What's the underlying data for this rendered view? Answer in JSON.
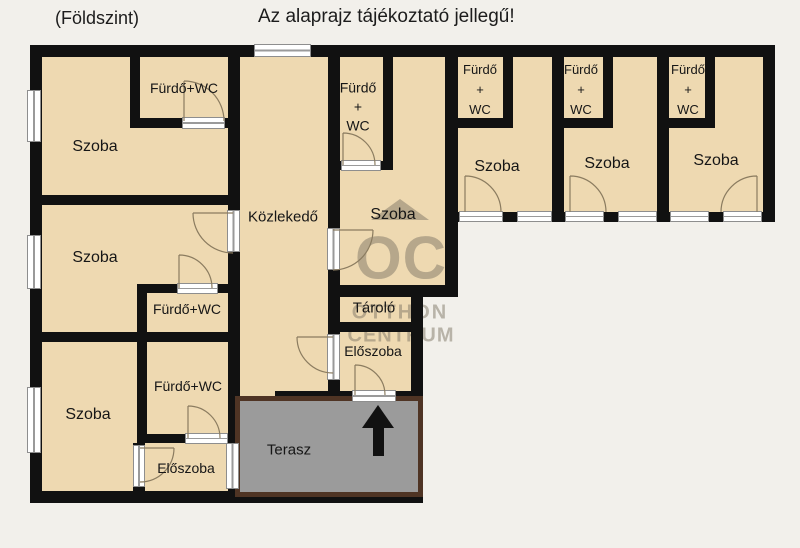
{
  "header": {
    "floor_label": "(Földszint)",
    "disclaimer": "Az alaprajz tájékoztató jellegű!"
  },
  "watermark": {
    "brand_initials": "OC",
    "brand_line1": "OTTHON",
    "brand_line2": "CENTRUM",
    "color": "#7d7566"
  },
  "rooms": {
    "szoba_top_left": {
      "label": "Szoba"
    },
    "furdo_top_left": {
      "label": "Fürdő+WC"
    },
    "szoba_mid_left": {
      "label": "Szoba"
    },
    "furdo_mid_left": {
      "label": "Fürdő+WC"
    },
    "szoba_bottom_left": {
      "label": "Szoba"
    },
    "furdo_bottom_left": {
      "label": "Fürdő+WC"
    },
    "eloszoba_left": {
      "label": "Előszoba"
    },
    "kozlekedo": {
      "label": "Közlekedő"
    },
    "furdo_middle": {
      "line1": "Fürdő",
      "line2": "+",
      "line3": "WC"
    },
    "szoba_middle": {
      "label": "Szoba"
    },
    "tarolo": {
      "label": "Tároló"
    },
    "eloszoba_right": {
      "label": "Előszoba"
    },
    "terasz": {
      "label": "Terasz"
    },
    "szoba_wing_1": {
      "label": "Szoba"
    },
    "furdo_wing_1": {
      "line1": "Fürdő",
      "line2": "+",
      "line3": "WC"
    },
    "szoba_wing_2": {
      "label": "Szoba"
    },
    "furdo_wing_2": {
      "line1": "Fürdő",
      "line2": "+",
      "line3": "WC"
    },
    "szoba_wing_3": {
      "label": "Szoba"
    },
    "furdo_wing_3": {
      "line1": "Fürdő",
      "line2": "+",
      "line3": "WC"
    }
  },
  "colors": {
    "wall": "#111111",
    "room_fill": "#eed9b1",
    "background": "#f2f0eb",
    "terrace_fill": "#9b9b9b",
    "terrace_border": "#4f3424",
    "window": "#ffffff",
    "door_arc": "#8b7c60",
    "arrow": "#111111"
  }
}
